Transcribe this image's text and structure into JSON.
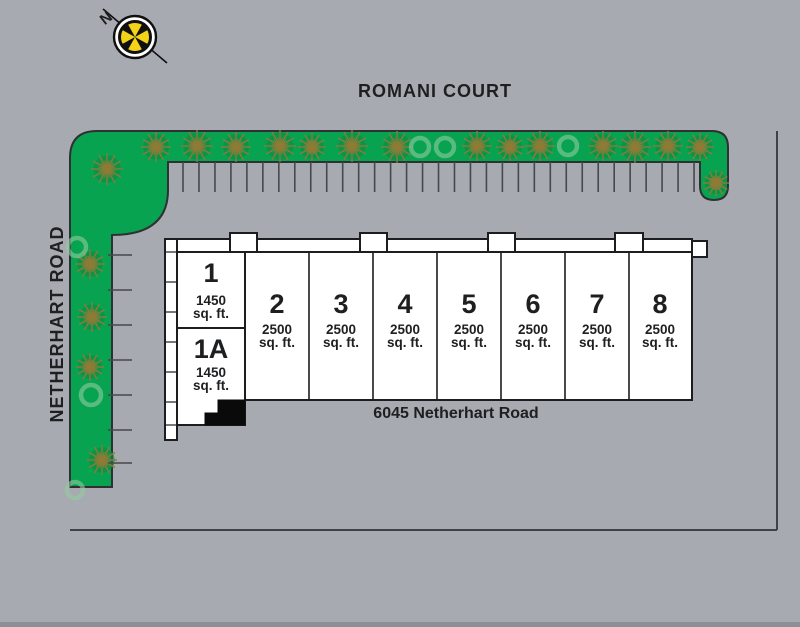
{
  "plan": {
    "type": "site-plan",
    "compass": {
      "north_label": "N"
    },
    "roads": {
      "top": "ROMANI COURT",
      "left": "NETHERHART ROAD"
    },
    "building": {
      "address": "6045 Netherhart Road",
      "units": [
        {
          "number": "1",
          "area": "1450",
          "area_unit": "sq. ft."
        },
        {
          "number": "1A",
          "area": "1450",
          "area_unit": "sq. ft."
        },
        {
          "number": "2",
          "area": "2500",
          "area_unit": "sq. ft."
        },
        {
          "number": "3",
          "area": "2500",
          "area_unit": "sq. ft."
        },
        {
          "number": "4",
          "area": "2500",
          "area_unit": "sq. ft."
        },
        {
          "number": "5",
          "area": "2500",
          "area_unit": "sq. ft."
        },
        {
          "number": "6",
          "area": "2500",
          "area_unit": "sq. ft."
        },
        {
          "number": "7",
          "area": "2500",
          "area_unit": "sq. ft."
        },
        {
          "number": "8",
          "area": "2500",
          "area_unit": "sq. ft."
        }
      ]
    },
    "parking": {
      "top_row_divider_count": 33,
      "left_row_divider_count": 7
    },
    "colors": {
      "background": "#a7aab0",
      "grass": "#07a350",
      "tree_branch": "#8d7b36",
      "tree_halo": "#0b8c46",
      "light_tree": "#93cba1",
      "compass_face": "#f2d318",
      "line": "#2e3033",
      "building_fill": "#ffffff",
      "stair_fill": "#0a0a0a"
    }
  }
}
